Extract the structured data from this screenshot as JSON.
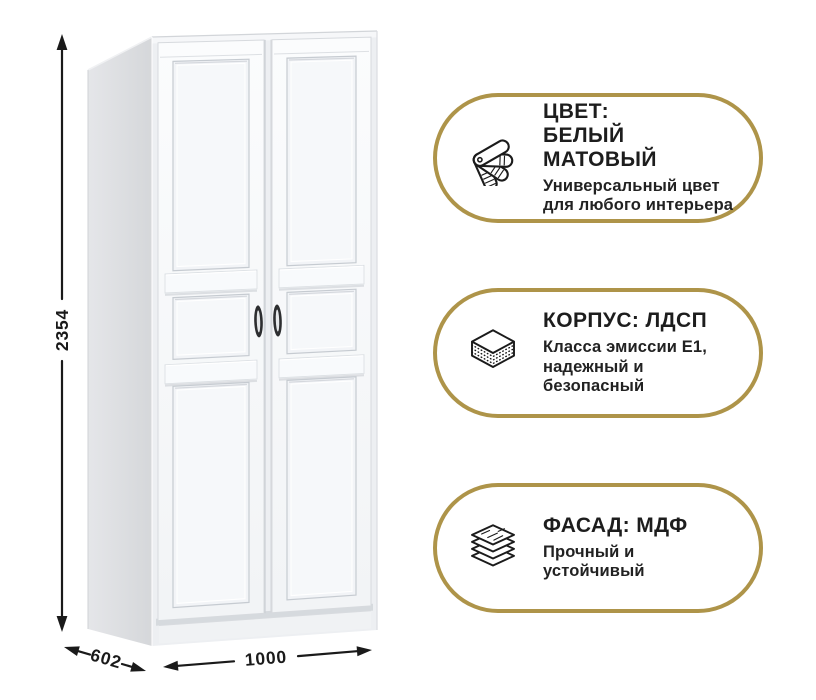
{
  "product": {
    "name": "wardrobe",
    "dimensions": {
      "height": "2354",
      "depth": "602",
      "width": "1000"
    }
  },
  "features": [
    {
      "id": "color",
      "icon": "color-swatches-fan-icon",
      "title": "ЦВЕТ:\nБЕЛЫЙ МАТОВЫЙ",
      "subtitle": "Универсальный цвет\nдля любого интерьера"
    },
    {
      "id": "body",
      "icon": "chipboard-layers-icon",
      "title": "КОРПУС: ЛДСП",
      "subtitle": "Класса эмиссии E1,\nнадежный и\nбезопасный"
    },
    {
      "id": "facade",
      "icon": "mdf-sheets-icon",
      "title": "ФАСАД: МДФ",
      "subtitle": "Прочный и\nустойчивый"
    }
  ],
  "colors": {
    "accent_gold": "#ae9449",
    "ink": "#1a1a1a",
    "cabinet_side_gray": "#dcdde0",
    "cabinet_front_white": "#f8fafc"
  }
}
